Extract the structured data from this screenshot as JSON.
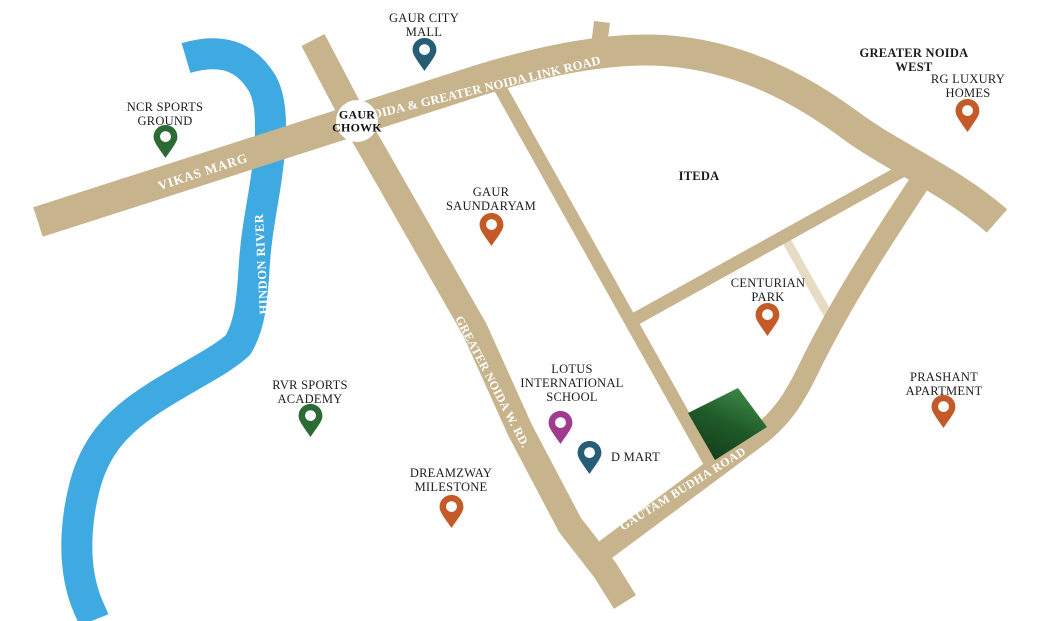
{
  "map": {
    "colors": {
      "road": "#c7b48d",
      "road_light": "#e6dcc4",
      "river": "#3fa9e1",
      "site_light": "#3f8b48",
      "site_mid": "#1f5a29",
      "site_dark": "#123d1b",
      "pin_teal": "#275e75",
      "pin_green": "#2c6b35",
      "pin_orange": "#c45a28",
      "pin_purple": "#a03b8f"
    },
    "junction": {
      "line1": "GAUR",
      "line2": "CHOWK"
    },
    "roads": {
      "vikas_marg": "VIKAS MARG",
      "link_road": "NOIDA & GREATER NOIDA LINK ROAD",
      "gn_west_rd": "GREATER NOIDA W. RD.",
      "gautam_budha": "GAUTAM BUDHA ROAD"
    },
    "river_label": "HINDON RIVER",
    "areas": {
      "iteda": "ITEDA",
      "gn_west": {
        "line1": "GREATER NOIDA",
        "line2": "WEST"
      }
    },
    "locations": {
      "gaur_city_mall": {
        "line1": "GAUR CITY",
        "line2": "MALL"
      },
      "ncr_sports_ground": {
        "line1": "NCR SPORTS",
        "line2": "GROUND"
      },
      "rg_luxury_homes": {
        "line1": "RG LUXURY",
        "line2": "HOMES"
      },
      "gaur_saundaryam": {
        "line1": "GAUR",
        "line2": "SAUNDARYAM"
      },
      "centurian_park": {
        "line1": "CENTURIAN",
        "line2": "PARK"
      },
      "rvr_sports_academy": {
        "line1": "RVR SPORTS",
        "line2": "ACADEMY"
      },
      "lotus_school": {
        "line1": "LOTUS",
        "line2": "INTERNATIONAL",
        "line3": "SCHOOL"
      },
      "d_mart": {
        "line1": "D MART"
      },
      "dreamzway_milestone": {
        "line1": "DREAMZWAY",
        "line2": "MILESTONE"
      },
      "prashant_apartment": {
        "line1": "PRASHANT",
        "line2": "APARTMENT"
      }
    }
  }
}
